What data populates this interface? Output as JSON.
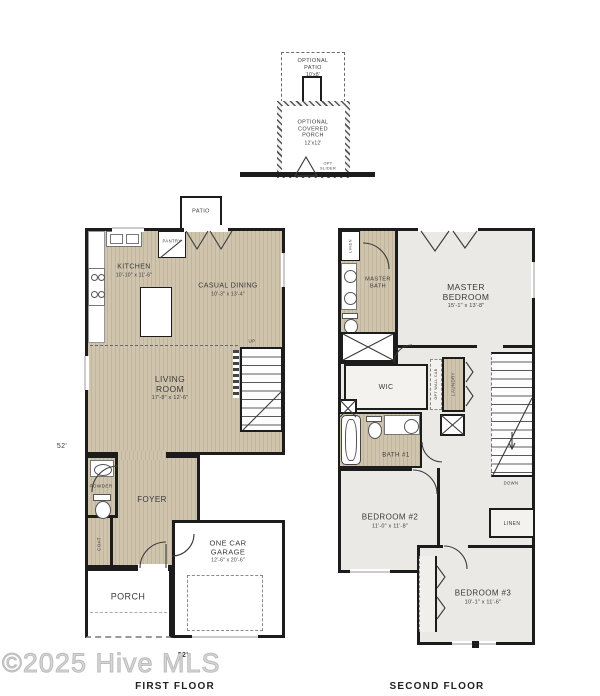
{
  "colors": {
    "wall": "#1c1c1c",
    "wood": "#cfc5af",
    "wood_stripe": "#c2b59c",
    "carpet": "#ebe9e5",
    "watermark": "#cccccc"
  },
  "optional": {
    "patio_title": "OPTIONAL PATIO",
    "patio_dim": "10'x8'",
    "porch_title": "OPTIONAL COVERED PORCH",
    "porch_dim": "12'x12'",
    "slider_label": "OPT SLIDER"
  },
  "first_floor": {
    "title": "FIRST FLOOR",
    "patio": "PATIO",
    "pantry": "PANTRY",
    "kitchen": {
      "name": "KITCHEN",
      "dim": "10'-10\" x 11'-6\""
    },
    "casual_dining": {
      "name": "CASUAL DINING",
      "dim": "10'-3\" x 13'-4\""
    },
    "living_room": {
      "name": "LIVING ROOM",
      "dim": "17'-8\" x 12'-6\""
    },
    "powder": "POWDER",
    "foyer": "FOYER",
    "coat": "COAT",
    "garage": {
      "name": "ONE CAR GARAGE",
      "dim": "12'-6\" x 20'-6\""
    },
    "porch": "PORCH",
    "stairs_up": "UP",
    "height_dim": "52'",
    "width_dim": "22'"
  },
  "second_floor": {
    "title": "SECOND FLOOR",
    "master_bath": "MASTER BATH",
    "linen_upper": "LINEN",
    "master_bedroom": {
      "name": "MASTER BEDROOM",
      "dim": "15'-1\" x 13'-8\""
    },
    "wic": "WIC",
    "opt_wall_cab": "OPT WALL CAB",
    "laundry": "LAUNDRY",
    "bath_1": "BATH #1",
    "stairs_down": "DOWN",
    "bedroom_2": {
      "name": "BEDROOM #2",
      "dim": "11'-0\" x 11'-8\""
    },
    "linen_hall": "LINEN",
    "bedroom_3": {
      "name": "BEDROOM #3",
      "dim": "10'-1\" x 11'-6\""
    }
  },
  "watermark": "©2025 Hive MLS"
}
